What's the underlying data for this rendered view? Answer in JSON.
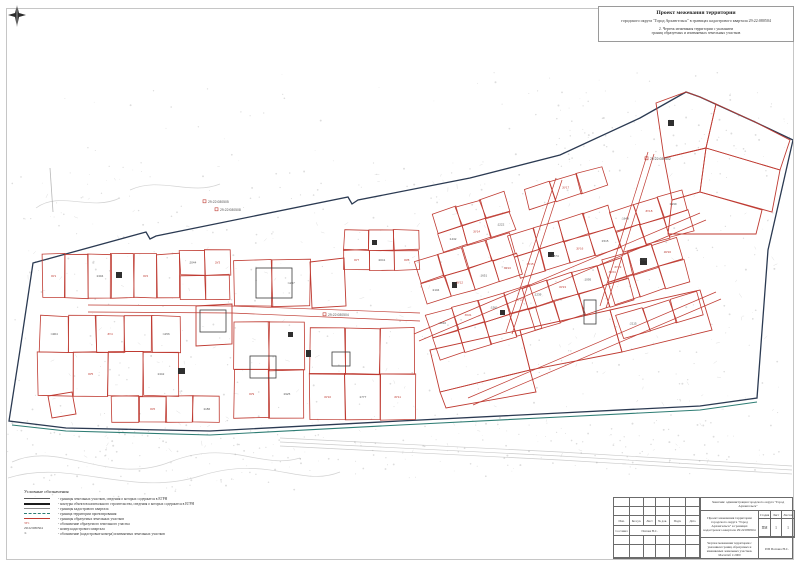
{
  "sheet": {
    "title_block_top": {
      "line1": "Проект межевания территории",
      "line2": "городского округа \"Город Архангельск\" в границах кадастрового квартала 29:22:080504",
      "line3": "2. Чертеж межевания территории с указанием",
      "line4": "границ образуемых и изменяемых земельных участков"
    }
  },
  "colors": {
    "parcel_red": "#bf3b32",
    "boundary_navy": "#2b3a52",
    "planning_teal": "#2e7d74",
    "base_gray": "#8f8f8f"
  },
  "map": {
    "quarter_number": "29:22:080504",
    "quarter_labels": [
      {
        "text": "29:22:080505",
        "x": 208,
        "y": 203
      },
      {
        "text": "29:22:080508",
        "x": 220,
        "y": 211
      },
      {
        "text": "29:22:080502",
        "x": 650,
        "y": 160
      },
      {
        "text": "29:22:080504",
        "x": 328,
        "y": 316
      }
    ],
    "formed_parcel_labels": [
      "ЗУ1",
      "ЗУ2",
      "ЗУ3",
      "ЗУ4",
      "ЗУ5",
      "ЗУ6",
      "ЗУ7",
      "ЗУ8",
      "ЗУ9",
      "ЗУ10",
      "ЗУ11",
      "ЗУ12",
      "ЗУ13",
      "ЗУ14",
      "ЗУ15",
      "ЗУ16",
      "ЗУ17",
      "ЗУ18",
      "ЗУ19",
      "ЗУ20",
      "ЗУ21",
      "ЗУ22",
      "ЗУ23",
      "ЗУ24"
    ],
    "existing_parcel_labels": [
      ":1304",
      ":2044",
      ":1904",
      ":1156",
      ":1342",
      ":1186",
      ":2041",
      ":1287",
      ":1925",
      ":1777",
      ":2104",
      ":1651",
      ":1432",
      ":1222",
      ":1874",
      ":1515",
      ":1648",
      ":1999",
      ":1733",
      ":1810",
      ":1561",
      ":1239",
      ":1095",
      ":2115"
    ]
  },
  "legend": {
    "title": "Условные обозначения",
    "items": [
      {
        "type": "line",
        "color": "#5a5a5a",
        "weight": 1,
        "label": "- границы земельных участков, сведения о которых содержатся в ЕГРН"
      },
      {
        "type": "line",
        "color": "#1c1c1c",
        "weight": 2,
        "label": "- контуры объектов капитального строительства, сведения о которых содержатся в ЕГРН"
      },
      {
        "type": "line",
        "color": "#8f8f8f",
        "weight": 1,
        "label": "- границы кадастрового квартала"
      },
      {
        "type": "dash",
        "color": "#2e7d74",
        "weight": 1,
        "label": "- граница территории проектирования"
      },
      {
        "type": "line",
        "color": "#bf3b32",
        "weight": 1.5,
        "label": "- границы образуемых земельных участков"
      },
      {
        "type": "text",
        "text": "ЗУ1",
        "color": "#bf3b32",
        "label": "- обозначение образуемого земельного участка"
      },
      {
        "type": "text",
        "text": "29:22:080504",
        "color": "#333333",
        "label": "- номер кадастрового квартала"
      },
      {
        "type": "text",
        "text": ":1",
        "color": "#333333",
        "label": "- обозначение (кадастровые номера) изменяемых земельных участков"
      }
    ]
  },
  "stamp": {
    "customer": "Заказчик: администрация городского округа \"Город Архангельск\"",
    "project": "Проект межевания территории городского округа \"Город Архангельск\" в границах кадастрового квартала 29:22:080504",
    "table_cols": [
      "Изм.",
      "Кол.уч.",
      "Лист",
      "№ док.",
      "Подп.",
      "Дата"
    ],
    "staff_role": "Составил",
    "staff_name": "Попова Н.С.",
    "stage_label": "Стадия",
    "sheet_label": "Лист",
    "sheets_label": "Листов",
    "stage_value": "ПМ",
    "sheet_value": "1",
    "sheets_value": "1",
    "drawing_title": "Чертеж межевания территории с указанием границ образуемых и изменяемых земельных участков. Масштаб 1:2000",
    "org": "ИП Попова Н.С."
  }
}
